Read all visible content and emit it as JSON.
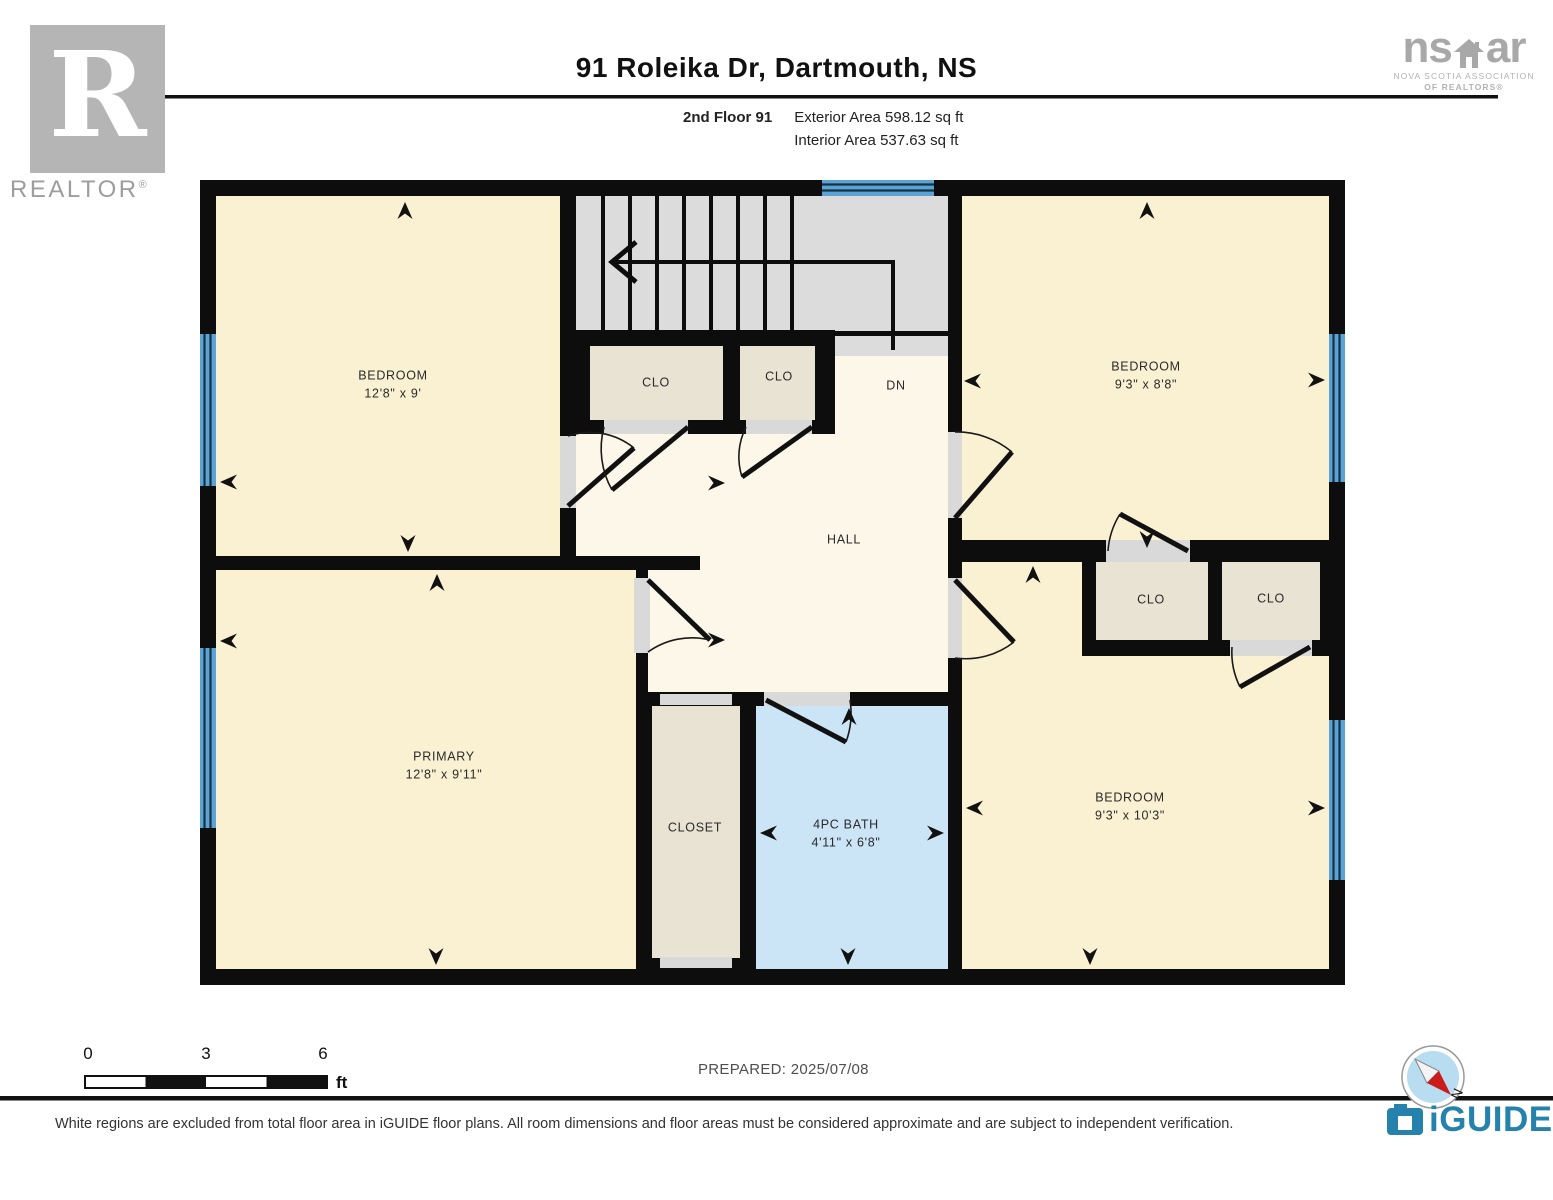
{
  "header": {
    "title": "91 Roleika Dr, Dartmouth, NS",
    "floor_label": "2nd Floor 91",
    "exterior_area": "Exterior Area 598.12 sq ft",
    "interior_area": "Interior Area 537.63 sq ft"
  },
  "branding": {
    "realtor_letter": "R",
    "realtor_wordmark": "REALTOR",
    "registered_mark": "®",
    "nsar_left": "ns",
    "nsar_right": "ar",
    "nsar_caption_1": "NOVA SCOTIA ASSOCIATION",
    "nsar_caption_2": "OF REALTORS®",
    "iguide_wordmark": "iGUIDE"
  },
  "rooms": {
    "bedroom_tl": {
      "name": "BEDROOM",
      "dims": "12'8\" x 9'"
    },
    "bedroom_tr": {
      "name": "BEDROOM",
      "dims": "9'3\" x 8'8\""
    },
    "bedroom_br": {
      "name": "BEDROOM",
      "dims": "9'3\" x 10'3\""
    },
    "primary": {
      "name": "PRIMARY",
      "dims": "12'8\" x 9'11\""
    },
    "bath": {
      "name": "4PC BATH",
      "dims": "4'11\" x 6'8\""
    },
    "hall": {
      "name": "HALL"
    },
    "closet": {
      "name": "CLOSET"
    },
    "clo_top_left": {
      "name": "CLO"
    },
    "clo_top_right": {
      "name": "CLO"
    },
    "clo_right_1": {
      "name": "CLO"
    },
    "clo_right_2": {
      "name": "CLO"
    },
    "stairs": {
      "name": "DN"
    }
  },
  "scale_bar": {
    "start": "0",
    "mid": "3",
    "end": "6",
    "unit": "ft"
  },
  "compass": {
    "north": "N"
  },
  "footer": {
    "prepared": "PREPARED: 2025/07/08",
    "disclaimer": "White regions are excluded from total floor area in iGUIDE floor plans. All room dimensions and floor areas must be considered approximate and are subject to independent verification."
  },
  "colors": {
    "room_fill": "#FAF0D2",
    "hall_fill": "#FCF7E8",
    "closet_fill": "#E9E3D4",
    "stairs_fill": "#DCDCDC",
    "bath_fill": "#CBE5F7",
    "window_blue": "#5BA3D6",
    "wall_black": "#0D0D0D",
    "door_gap": "#D9D9D9",
    "iguide_teal": "#2482AC",
    "compass_red": "#CC1B1B"
  }
}
